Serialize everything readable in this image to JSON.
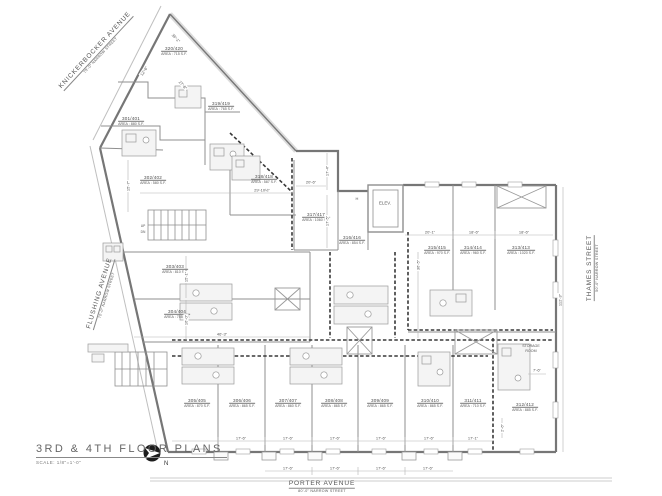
{
  "title_block": {
    "title": "3RD  &  4TH  FLOOR  PLANS",
    "scale": "SCALE:    1/8\"=1'-0\"",
    "north_label": "N"
  },
  "streets": {
    "knickerbocker": {
      "name": "KNICKERBOCKER AVENUE",
      "note": "70'-0\" NARROW STREET"
    },
    "flushing": {
      "name": "FLUSHING AVENUE",
      "note": "70'-0\" NARROW STREET"
    },
    "thames": {
      "name": "THAMES STREET",
      "note": "50'-0\" NARROW STREET"
    },
    "porter": {
      "name": "PORTER AVENUE",
      "note": "80'-0\" NARROW STREET"
    }
  },
  "rooms": {
    "elevator": "ELEV.",
    "storage_line1": "STORAGE",
    "storage_line2": "ROOM",
    "hall_tag": "H",
    "stair_up": "UP",
    "stair_dn": "DN"
  },
  "units": [
    {
      "number": "320/420",
      "area": "AREA : 715 S.F."
    },
    {
      "number": "301/401",
      "area": "AREA : 880 S.F."
    },
    {
      "number": "319/419",
      "area": "AREA : 765 S.F."
    },
    {
      "number": "302/402",
      "area": "AREA : 580 S.F."
    },
    {
      "number": "318/418",
      "area": "AREA : 587 S.F."
    },
    {
      "number": "317/417",
      "area": "AREA : 1060 S.F."
    },
    {
      "number": "316/416",
      "area": "AREA : 854 S.F."
    },
    {
      "number": "303/403",
      "area": "AREA : 810 S.F."
    },
    {
      "number": "304/404",
      "area": "AREA : 755 S.F."
    },
    {
      "number": "315/415",
      "area": "AREA : 970 S.F."
    },
    {
      "number": "314/414",
      "area": "AREA : 960 S.F."
    },
    {
      "number": "313/413",
      "area": "AREA : 1020 S.F."
    },
    {
      "number": "305/405",
      "area": "AREA : 870 S.F."
    },
    {
      "number": "306/406",
      "area": "AREA : 865 S.F."
    },
    {
      "number": "307/407",
      "area": "AREA : 860 S.F."
    },
    {
      "number": "308/408",
      "area": "AREA : 865 S.F."
    },
    {
      "number": "309/409",
      "area": "AREA : 865 S.F."
    },
    {
      "number": "310/410",
      "area": "AREA : 865 S.F."
    },
    {
      "number": "311/411",
      "area": "AREA : 710 S.F."
    },
    {
      "number": "312/412",
      "area": "AREA : 885 S.F."
    }
  ],
  "dims": [
    "29'-10½\"",
    "46'-3\"",
    "15'-7\"",
    "15'-1\"",
    "16'-0\"",
    "17'-4\"",
    "17'-5\"",
    "20'-6\"",
    "36'-5\"",
    "20'-1\"",
    "18'-6\"",
    "18'-6\"",
    "17'-6\"",
    "17'-6\"",
    "17'-6\"",
    "17'-6\"",
    "17'-6\"",
    "17'-1\"",
    "17'-6\"",
    "17'-6\"",
    "17'-6\"",
    "17'-6\"",
    "112'-3\"",
    "7'-6\"",
    "2'-6\"",
    "12'-6\"",
    "27'-8\"",
    "36'-1\""
  ],
  "colors": {
    "wall": "#8a8a8a",
    "corridor_dash": "#333333",
    "text": "#4a4a4a"
  }
}
